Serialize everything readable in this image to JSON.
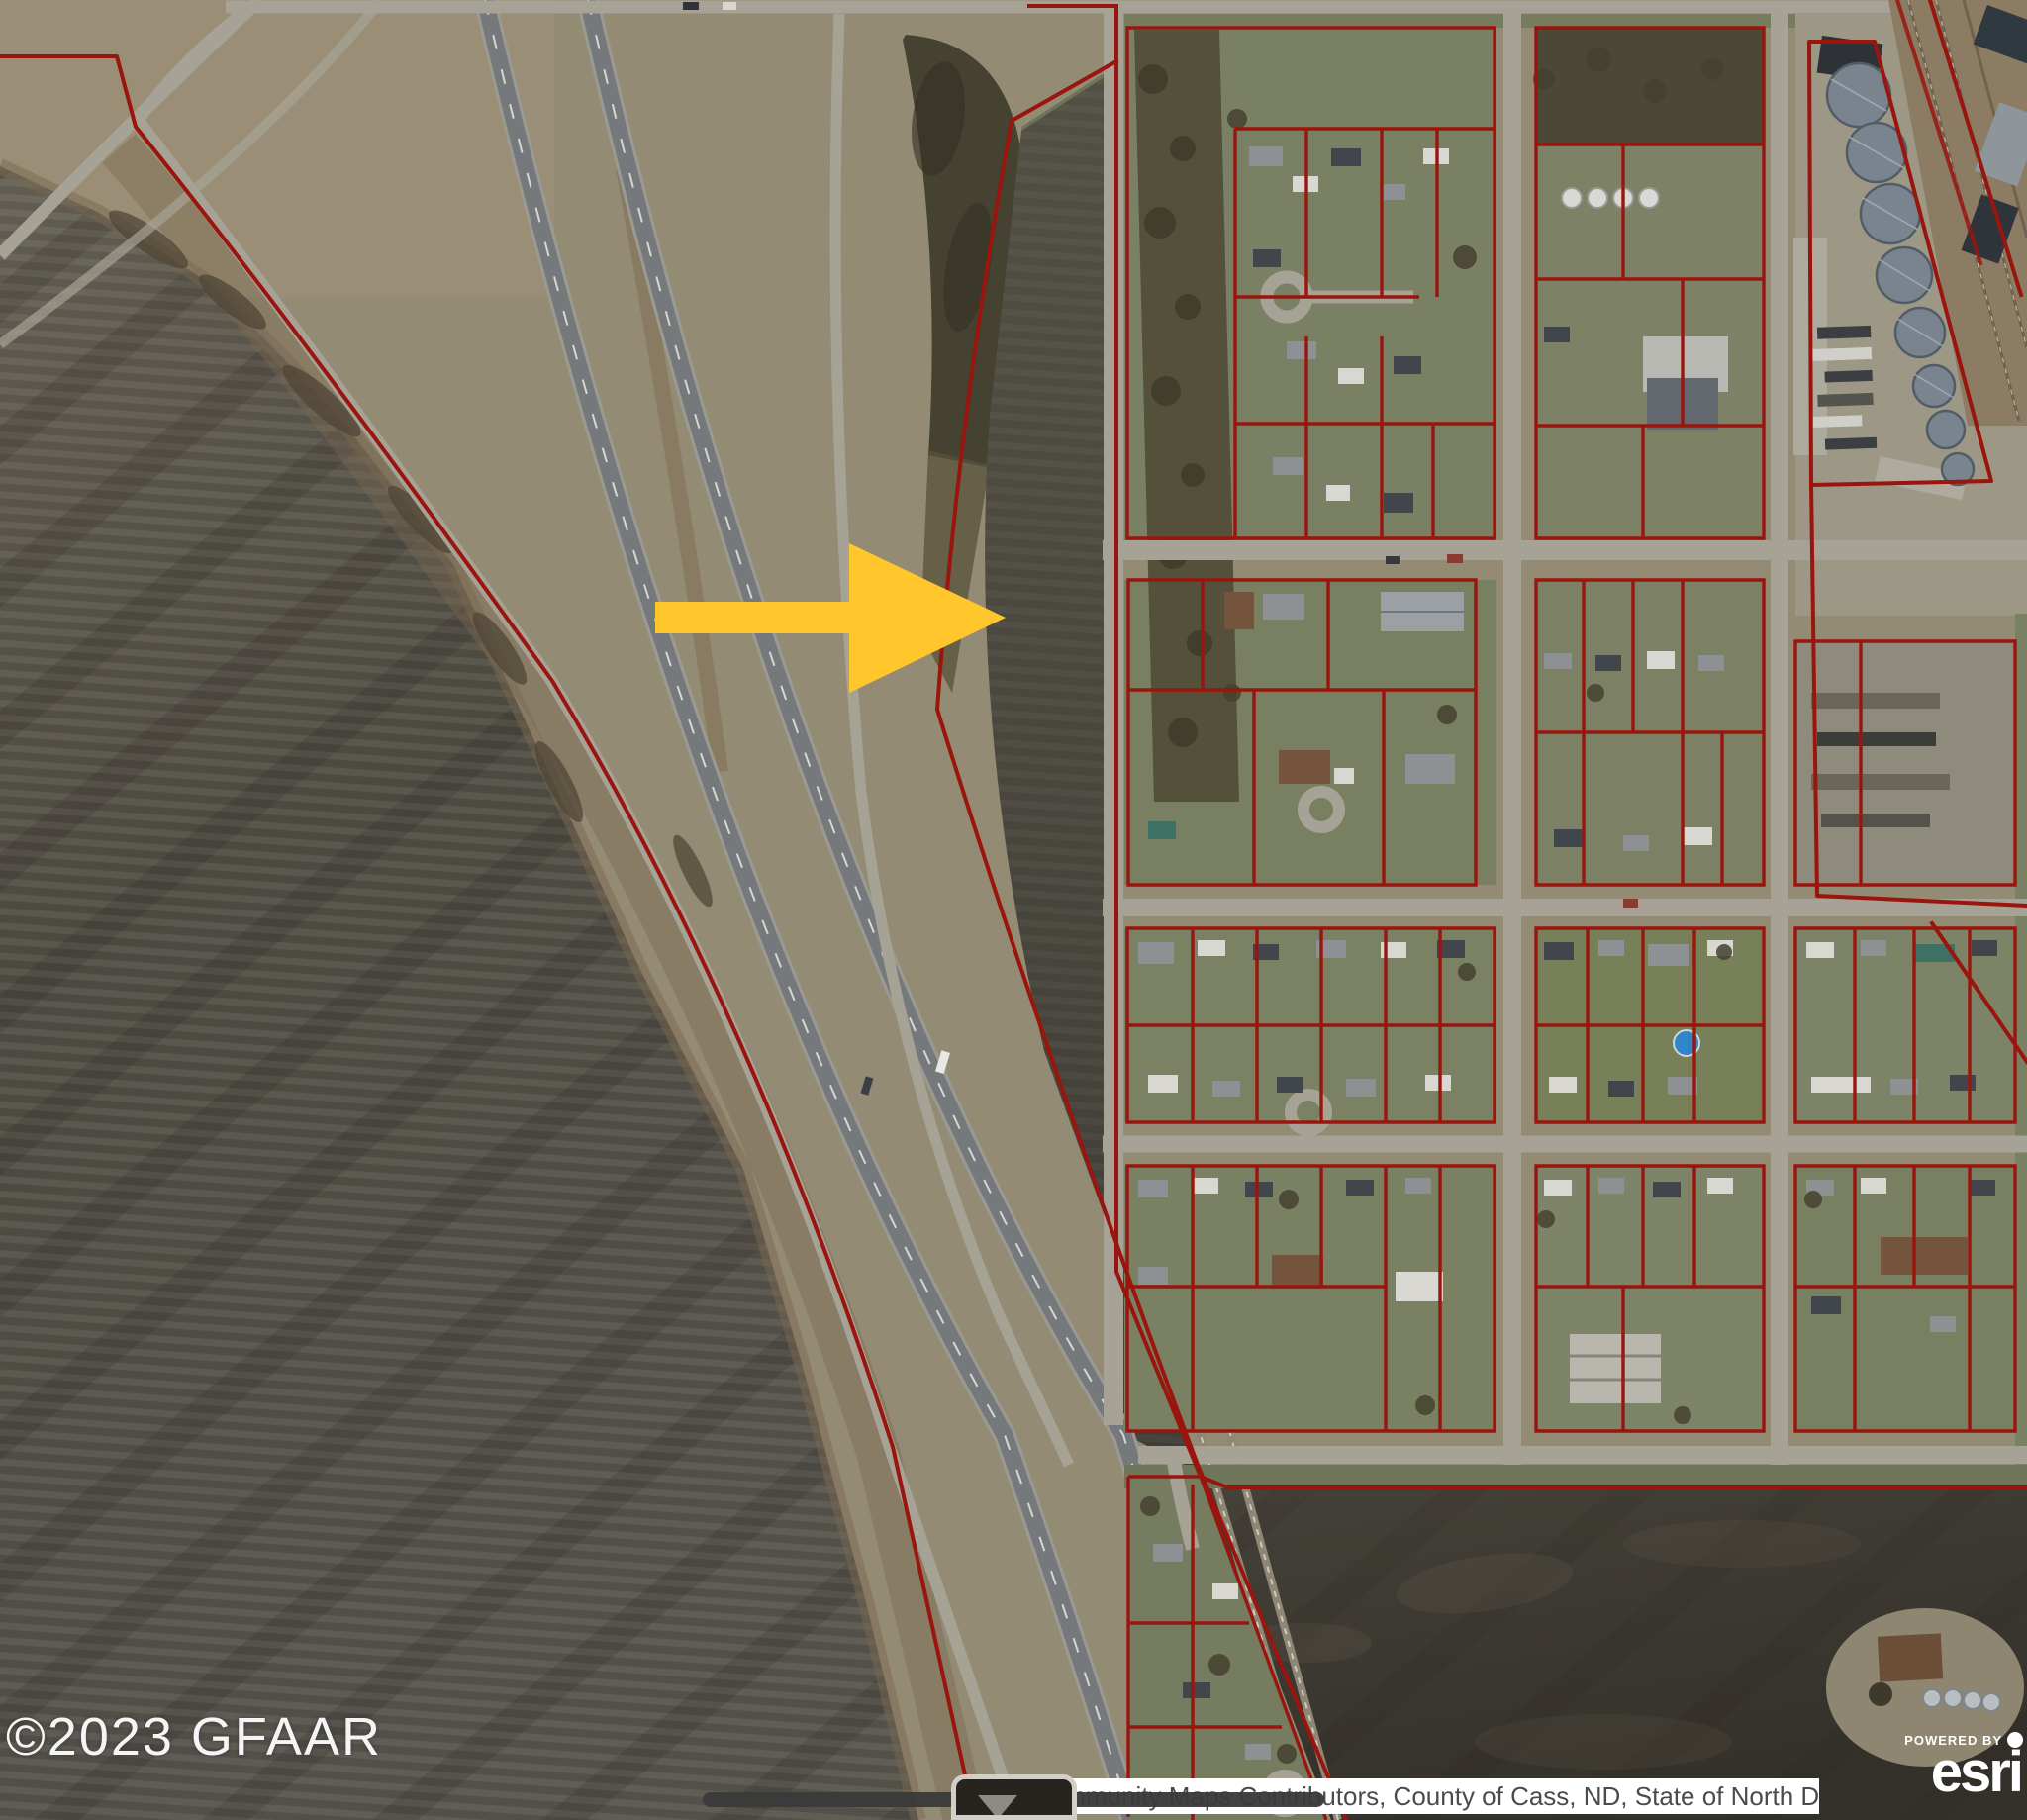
{
  "watermark": {
    "text": "©2023 GFAAR"
  },
  "attribution": {
    "text": "Esri Community Maps Contributors, County of Cass, ND, State of North Da…"
  },
  "branding": {
    "powered_by_label": "POWERED BY",
    "logo_text": "esri"
  },
  "annotation": {
    "icon": "right-arrow-icon",
    "direction": "right",
    "color": "#FFC72B"
  },
  "map": {
    "type": "aerial-satellite",
    "boundary_color": "#9A150D",
    "features": [
      "plowed-fields",
      "interstate-highway",
      "frontage-roads",
      "residential-town-grid",
      "parcel-boundaries",
      "grain-elevator-silos",
      "railroad"
    ]
  }
}
